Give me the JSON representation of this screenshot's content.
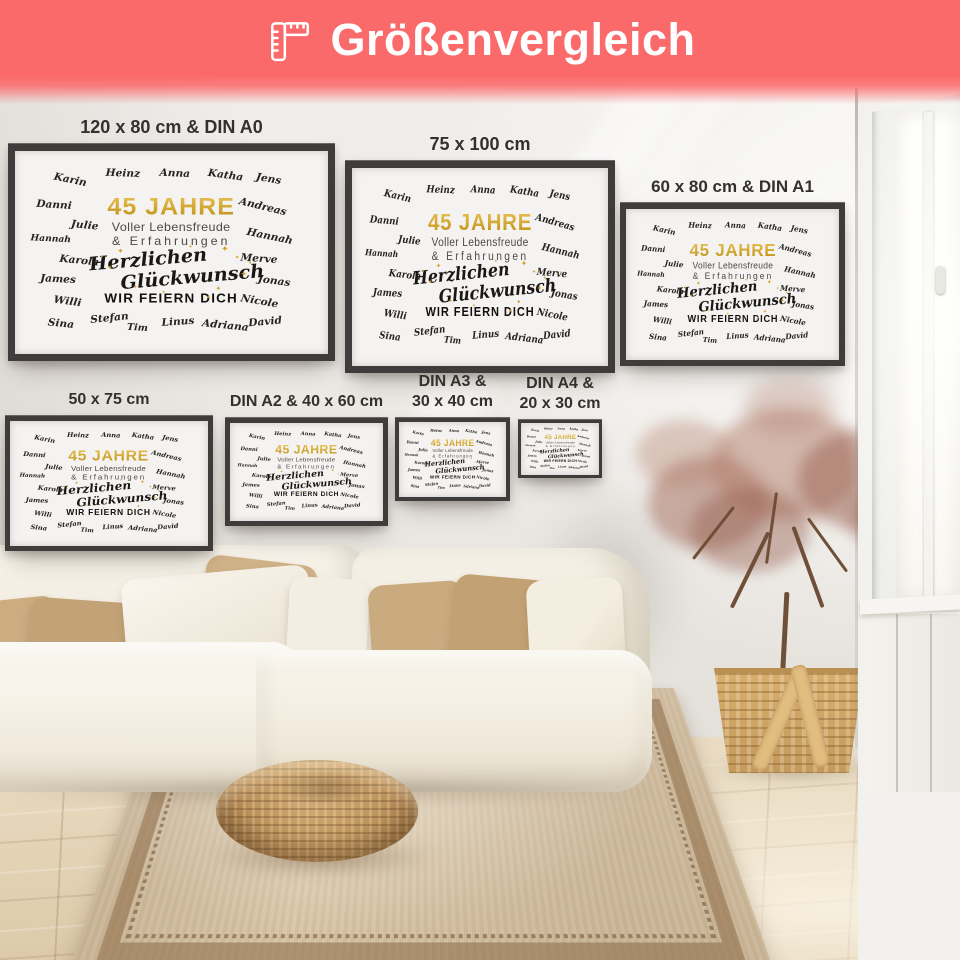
{
  "banner": {
    "title": "Größenvergleich",
    "icon": "ruler-icon",
    "background_color": "#fb6a6a",
    "text_color": "#ffffff"
  },
  "frames": [
    {
      "label_lines": [
        "120 x 80 cm & DIN A0"
      ]
    },
    {
      "label_lines": [
        "75 x 100 cm"
      ]
    },
    {
      "label_lines": [
        "60 x 80 cm & DIN A1"
      ]
    },
    {
      "label_lines": [
        "50 x 75 cm"
      ]
    },
    {
      "label_lines": [
        "DIN A2 & 40 x 60 cm"
      ]
    },
    {
      "label_lines": [
        "DIN A3 &",
        "30 x 40 cm"
      ]
    },
    {
      "label_lines": [
        "DIN A4 &",
        "20 x 30 cm"
      ]
    }
  ],
  "poster": {
    "title": "45 JAHRE",
    "subtitle1": "Voller Lebensfreude",
    "subtitle2": "& Erfahrungen",
    "script1": "Herzlichen",
    "script2": "Glückwunsch",
    "footer": "WIR FEIERN DICH",
    "names": [
      "Karin",
      "Heinz",
      "Anna",
      "Katha",
      "Jens",
      "Danni",
      "Andreas",
      "Julie",
      "Hannah",
      "Hannah",
      "Karola",
      "Merve",
      "James",
      "Jonas",
      "Willi",
      "Nicole",
      "Sina",
      "Stefan",
      "Tim",
      "Linus",
      "Adriana",
      "David"
    ],
    "colors": {
      "gold": "#d2a01f",
      "text": "#1e1d1b"
    }
  }
}
